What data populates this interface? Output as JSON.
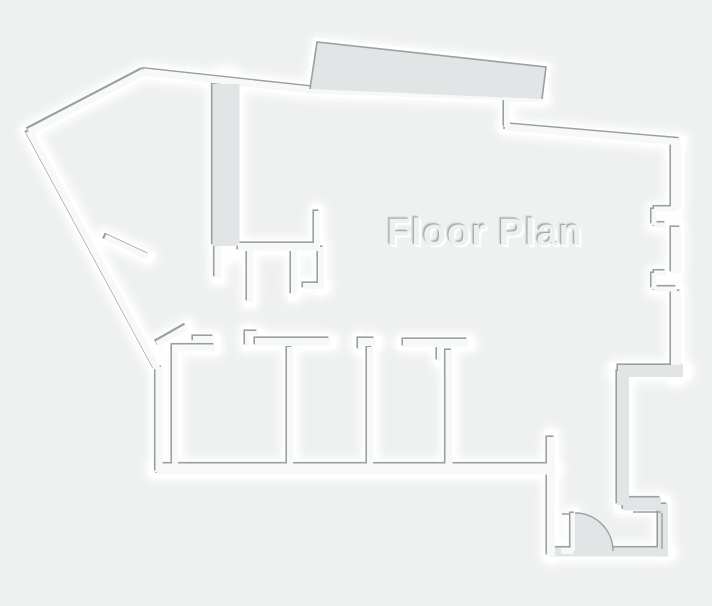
{
  "title": "Floor Plan",
  "canvas": {
    "width": 712,
    "height": 606
  },
  "colors": {
    "background": "#eff1f1",
    "wall_fill_thick": "#e2e5e5",
    "wall_fill_thin": "#f7f9f9",
    "wall_highlight": "#ffffff",
    "wall_shadow": "#9aa0a1",
    "door_swing_fill": "#e2e5e6",
    "title_text": "#edf0f0"
  }
}
